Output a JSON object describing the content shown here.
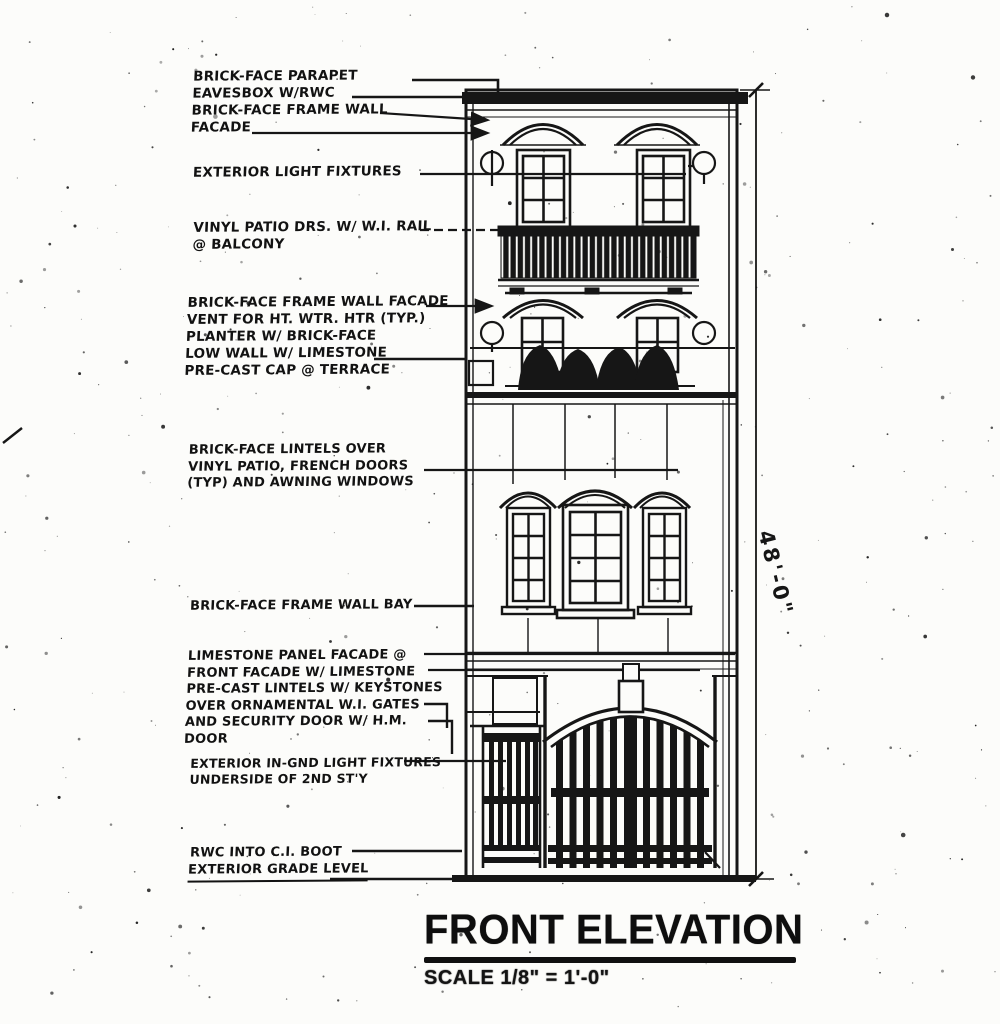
{
  "page": {
    "background": "#fcfcfa",
    "ink": "#161616"
  },
  "drawing": {
    "title": "FRONT ELEVATION",
    "scale_label": "SCALE 1/8\" = 1'-0\"",
    "height_dimension": "48'-0\""
  },
  "annotations": [
    {
      "id": "parapet",
      "lines": [
        "BRICK-FACE PARAPET",
        "EAVESBOX W/RWC",
        "BRICK-FACE FRAME WALL",
        "FACADE"
      ]
    },
    {
      "id": "exterior-lights",
      "lines": [
        "EXTERIOR LIGHT FIXTURES"
      ]
    },
    {
      "id": "balcony",
      "lines": [
        "VINYL PATIO DRS. W/ W.I. RAIL",
        "@ BALCONY"
      ]
    },
    {
      "id": "terrace",
      "lines": [
        "BRICK-FACE FRAME WALL FACADE",
        "VENT FOR HT. WTR. HTR (TYP.)",
        "PLANTER W/ BRICK-FACE",
        "LOW WALL W/ LIMESTONE",
        "PRE-CAST CAP @ TERRACE"
      ]
    },
    {
      "id": "lintels",
      "lines": [
        "BRICK-FACE LINTELS OVER",
        "VINYL PATIO, FRENCH DOORS",
        "(TYP) AND AWNING WINDOWS"
      ]
    },
    {
      "id": "bay",
      "lines": [
        "BRICK-FACE FRAME WALL BAY"
      ]
    },
    {
      "id": "limestone",
      "lines": [
        "LIMESTONE PANEL FACADE @",
        "FRONT FACADE W/ LIMESTONE",
        "PRE-CAST LINTELS W/ KEYSTONES",
        "OVER ORNAMENTAL W.I. GATES",
        "AND SECURITY DOOR W/ H.M.",
        "DOOR"
      ]
    },
    {
      "id": "in-gnd-lights",
      "lines": [
        "EXTERIOR IN-GND LIGHT FIXTURES",
        "UNDERSIDE OF 2ND ST'Y"
      ]
    },
    {
      "id": "rwc-boot",
      "lines": [
        "RWC INTO C.I. BOOT"
      ]
    },
    {
      "id": "grade-level",
      "lines": [
        "EXTERIOR GRADE LEVEL"
      ]
    }
  ]
}
